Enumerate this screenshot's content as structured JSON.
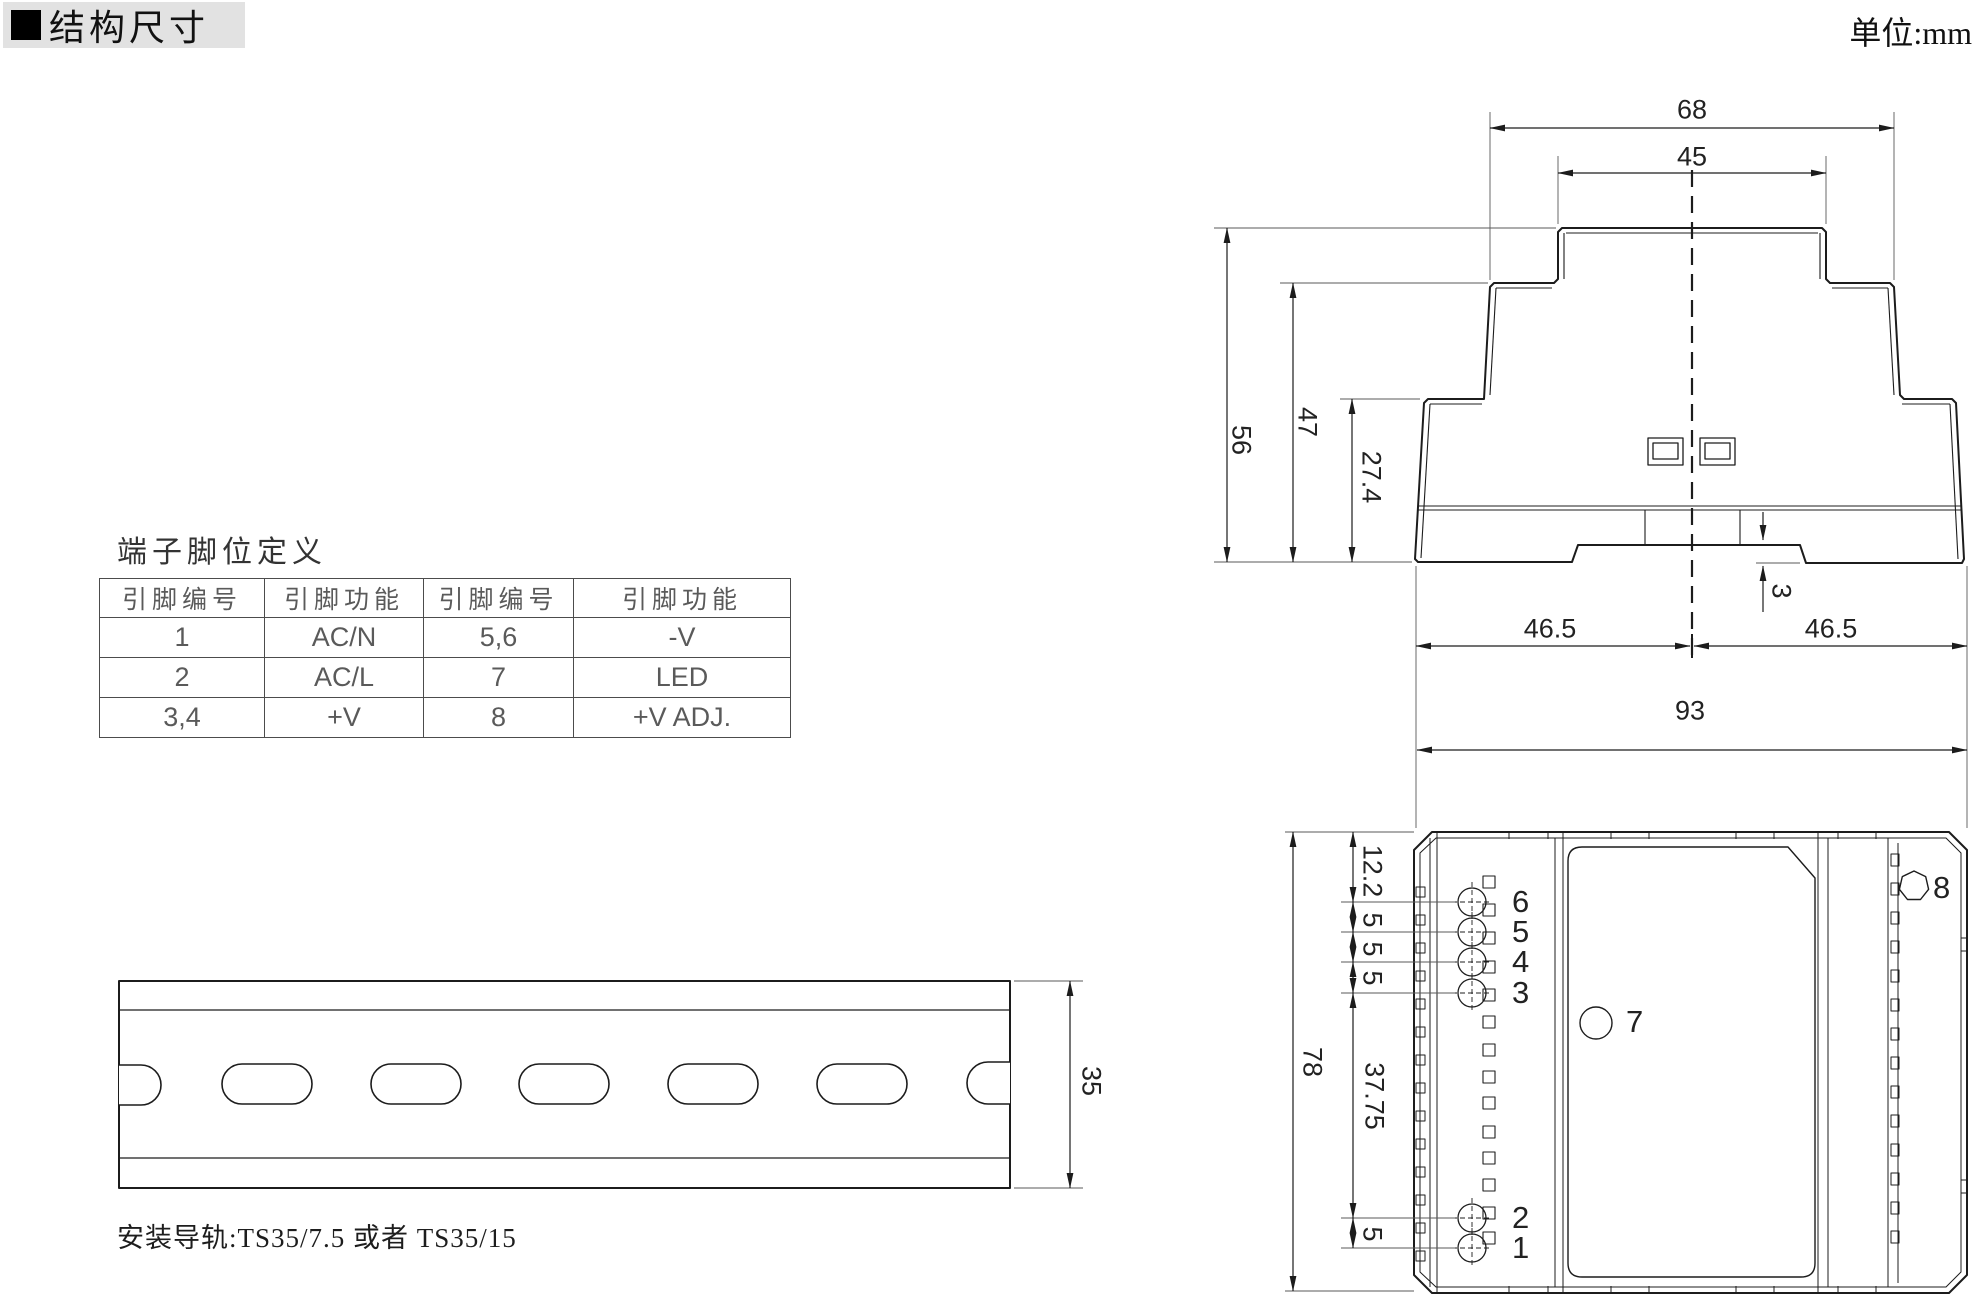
{
  "page": {
    "title_marker": "■",
    "title": "结构尺寸",
    "unit_label": "单位:mm"
  },
  "pin_table": {
    "title": "端子脚位定义",
    "headers": [
      "引脚编号",
      "引脚功能",
      "引脚编号",
      "引脚功能"
    ],
    "rows": [
      [
        "1",
        "AC/N",
        "5,6",
        "-V"
      ],
      [
        "2",
        "AC/L",
        "7",
        "LED"
      ],
      [
        "3,4",
        "+V",
        "8",
        "+V ADJ."
      ]
    ]
  },
  "side_view": {
    "dims": {
      "width_68": "68",
      "width_45": "45",
      "height_56": "56",
      "height_47": "47",
      "height_27_4": "27.4",
      "depth_3": "3",
      "left_46_5": "46.5",
      "right_46_5": "46.5"
    }
  },
  "front_view": {
    "dims": {
      "width_93": "93",
      "height_78": "78",
      "top_12_2": "12.2",
      "pitch_5a": "5",
      "pitch_5b": "5",
      "pitch_5c": "5",
      "mid_37_75": "37.75",
      "bottom_5": "5"
    },
    "pin_labels": [
      "6",
      "5",
      "4",
      "3",
      "2",
      "1"
    ],
    "led_label": "7",
    "adj_label": "8"
  },
  "din_rail": {
    "dim_35": "35",
    "caption": "安装导轨:TS35/7.5 或者 TS35/15"
  },
  "colors": {
    "line": "#1c1c1c",
    "thin": "#5a5a5a",
    "text": "#222222",
    "header_bg": "#e2e2e2"
  }
}
